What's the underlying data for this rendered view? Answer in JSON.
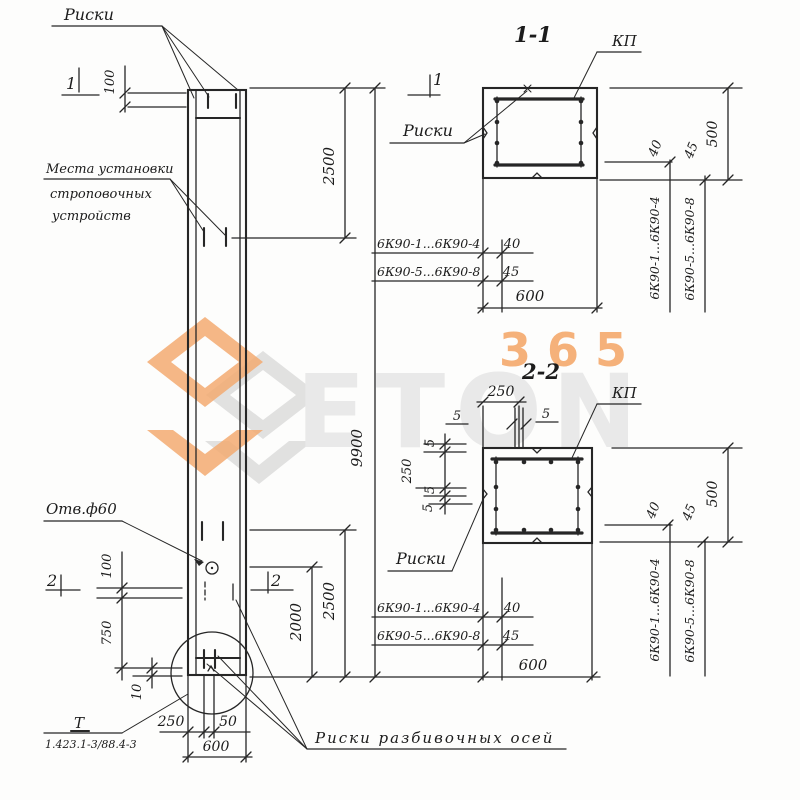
{
  "watermark": {
    "word": "ETON",
    "num": "365",
    "orange": "#f2a263",
    "gray": "#e3e3e3"
  },
  "labels": {
    "riski": "Риски",
    "riski_axes": "Риски разбивочных осей",
    "mesta1": "Места установки",
    "mesta2": "строповочных",
    "mesta3": "устройств",
    "otv": "Отв.ф60",
    "kp": "КП",
    "datum": "Т",
    "series": "1.423.1-3/88.4-3"
  },
  "sections": {
    "s1": "1-1",
    "s2": "2-2"
  },
  "cuts": {
    "c1": "1",
    "c2": "2"
  },
  "marks": {
    "r14": "6К90-1...6К90-4",
    "r58": "6К90-5...6К90-8"
  },
  "dims": {
    "d5": "5",
    "d10": "10",
    "d40": "40",
    "d45": "45",
    "d50": "50",
    "d100": "100",
    "d250": "250",
    "d500": "500",
    "d600": "600",
    "d750": "750",
    "d2000": "2000",
    "d2500": "2500",
    "d9900": "9900"
  }
}
